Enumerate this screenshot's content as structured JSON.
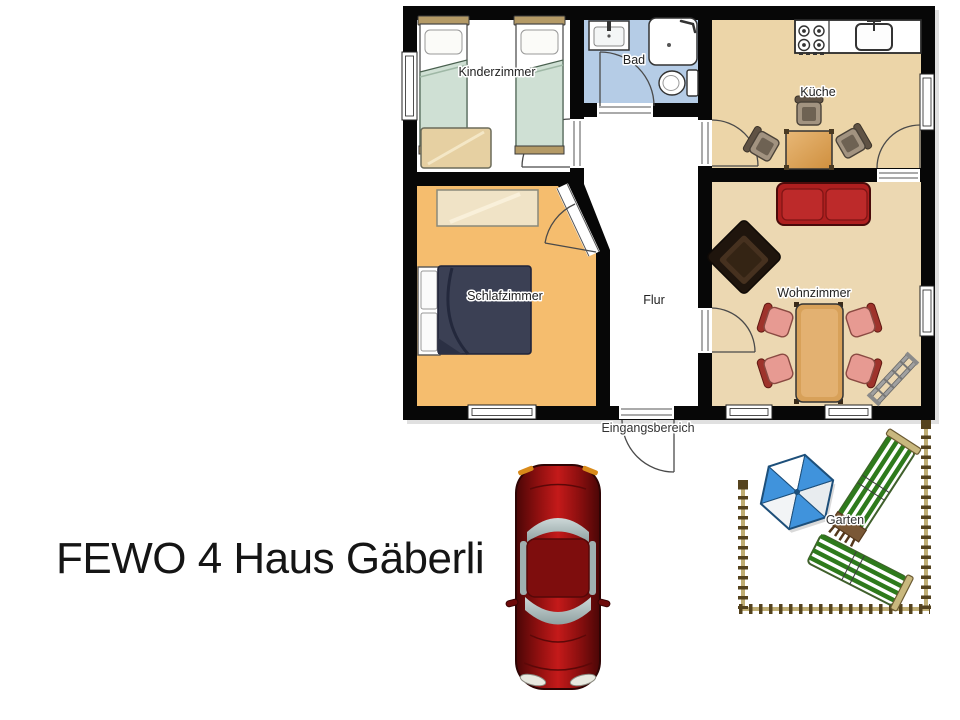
{
  "title": "FEWO 4 Haus Gäberli",
  "floorplan": {
    "rooms": [
      {
        "id": "kinderzimmer",
        "label": "Kinderzimmer"
      },
      {
        "id": "bad",
        "label": "Bad"
      },
      {
        "id": "kueche",
        "label": "Küche"
      },
      {
        "id": "schlafzimmer",
        "label": "Schlafzimmer"
      },
      {
        "id": "flur",
        "label": "Flur"
      },
      {
        "id": "wohnzimmer",
        "label": "Wohnzimmer"
      }
    ],
    "entrance_label": "Eingangsbereich",
    "garden_label": "Garten"
  },
  "colors": {
    "wall": "#070707",
    "kinderzimmer_floor": "#ffffff",
    "bad_floor": "#b5cce6",
    "kueche_floor": "#ecd5a8",
    "schlafzimmer_floor": "#f5bd6e",
    "flur_floor": "#ffffff",
    "wohnzimmer_floor": "#ecd8b2",
    "sofa_red": "#ae1f1f",
    "double_bed_navy": "#3b4054",
    "single_bed_green": "#cfe0d4",
    "umbrella_blue": "#4093dc",
    "lounger_green": "#2e7a1c",
    "fence_tan": "#c0ae74",
    "car_red": "#c41a1a"
  }
}
